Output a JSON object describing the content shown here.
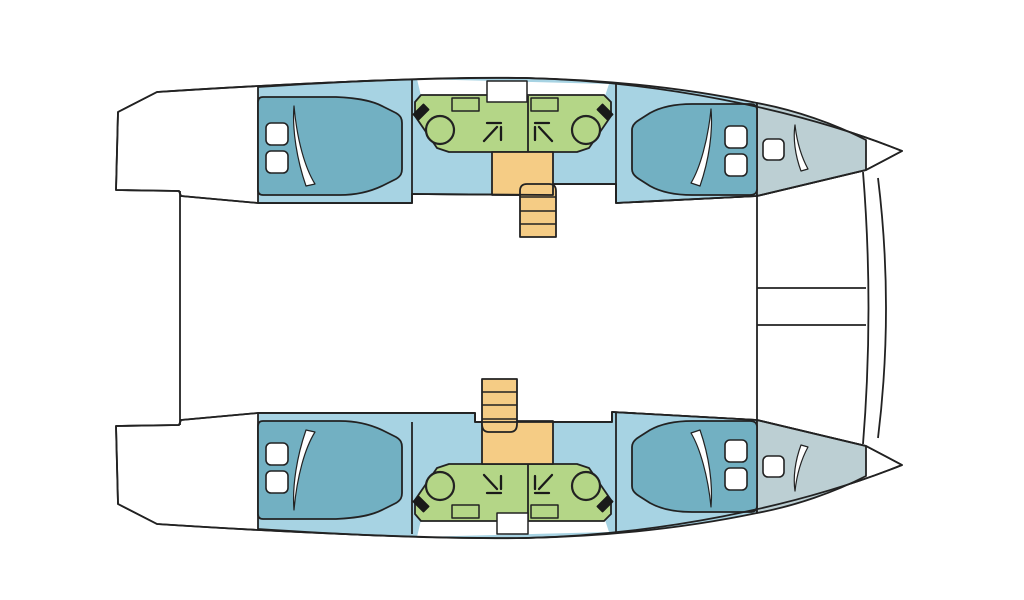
{
  "diagram": {
    "type": "catamaran-floor-plan",
    "view": "overhead-deck-plan",
    "orientation": "bow-right",
    "colors": {
      "background": "#ffffff",
      "outline": "#222222",
      "deck": "#ffffff",
      "cabin_floor": "#a7d3e3",
      "bed": "#72b0c2",
      "forepeak": "#bccfd3",
      "bathroom": "#b4d687",
      "stairs": "#f5cc85",
      "linen": "#ffffff",
      "fixture": "#1a1a1a"
    },
    "shared": {
      "transom_line": true,
      "foredeck_walkway_rails": 2,
      "bow_crossbeam_arcs": 2
    },
    "hulls": [
      {
        "name": "port-hull",
        "position": "top",
        "aft_cabin": {
          "berth": "double",
          "pillows": 2,
          "duvet_fold": true
        },
        "forward_cabin": {
          "berth": "double",
          "pillows": 2,
          "duvet_fold": true
        },
        "forepeak_berth": {
          "berth": "single",
          "pillows": 1,
          "duvet_fold": true
        },
        "bathrooms": {
          "count": 2,
          "fixtures_each": [
            "sink",
            "shower",
            "cabinet"
          ],
          "door": true
        },
        "companionway": {
          "landing": true,
          "steps": 4,
          "stair_side": "forward-of-landing"
        }
      },
      {
        "name": "starboard-hull",
        "position": "bottom",
        "aft_cabin": {
          "berth": "double",
          "pillows": 2,
          "duvet_fold": true
        },
        "forward_cabin": {
          "berth": "double",
          "pillows": 2,
          "duvet_fold": true
        },
        "forepeak_berth": {
          "berth": "single",
          "pillows": 1,
          "duvet_fold": true
        },
        "bathrooms": {
          "count": 2,
          "fixtures_each": [
            "sink",
            "shower",
            "cabinet"
          ],
          "door": true
        },
        "companionway": {
          "landing": true,
          "steps": 4,
          "stair_side": "aft-of-landing"
        }
      }
    ]
  }
}
